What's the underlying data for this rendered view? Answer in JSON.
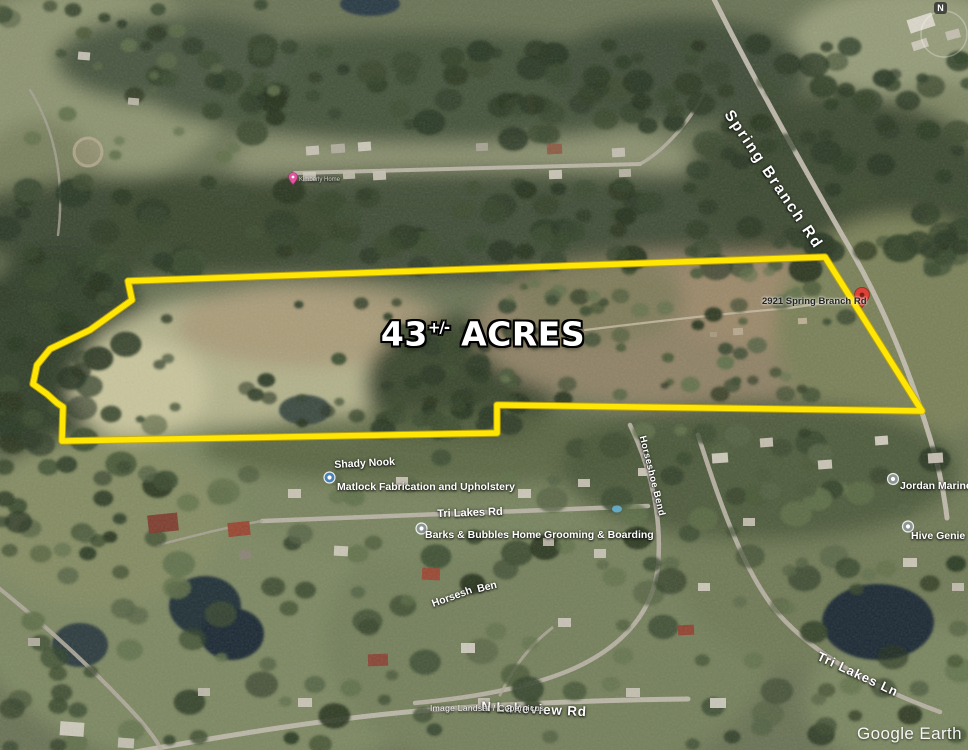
{
  "map": {
    "acres": {
      "number": "43",
      "tolerance": "+/-",
      "unit": "ACRES"
    },
    "roads": {
      "spring_branch": "Spring Branch Rd",
      "tri_lakes_rd": "Tri Lakes Rd",
      "tri_lakes_ln": "Tri Lakes Ln",
      "horseshoe_bend": "Horseshoe Bend",
      "horseshoe_part1": "Horsesh",
      "horseshoe_part2": "Ben",
      "n_lakeview": "N Lakeview Rd"
    },
    "places": {
      "address": "2921 Spring Branch Rd",
      "shady_nook": "Shady Nook",
      "matlock": "Matlock Fabrication and Upholstery",
      "barks": "Barks & Bubbles Home Grooming & Boarding",
      "jordan": "Jordan Marine Cons",
      "hive": "Hive Genie",
      "kimberly": "Kimberly Home"
    },
    "attribution": {
      "imagery": "Image Landsat / Copernicus",
      "brand": "Google Earth"
    },
    "compass": {
      "north": "N"
    },
    "colors": {
      "boundary_yellow": "#ffe604",
      "boundary_edge": "#c7a900",
      "pin_red": "#dd4236",
      "pin_pink": "#e0559e",
      "marker_blue": "#4a80b4",
      "marker_gray": "#8b9591"
    }
  }
}
